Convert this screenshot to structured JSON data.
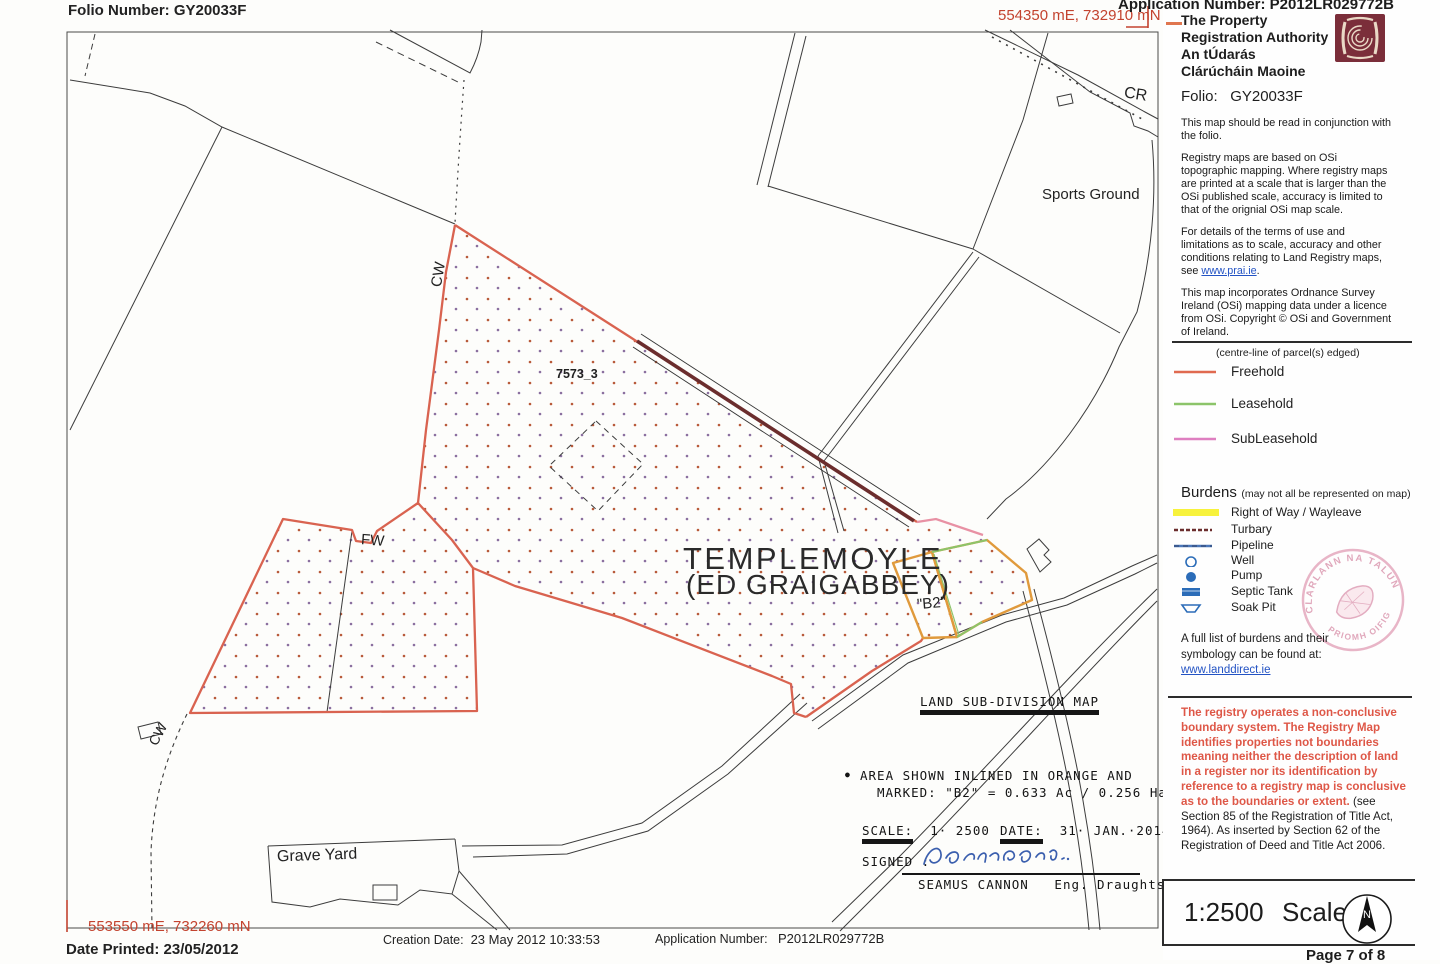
{
  "header": {
    "folio_number": "Folio Number: GY20033F",
    "application_number": "Application Number: P2012LR029772B",
    "coord_top": "554350 mE, 732910 mN"
  },
  "panel": {
    "authority_line1": "The Property",
    "authority_line2": "Registration Authority",
    "authority_line3": "An tÚdarás",
    "authority_line4": "Clárúcháin Maoine",
    "folio_label": "Folio:",
    "folio_value": "GY20033F",
    "para1": "This map should be read in conjunction with the folio.",
    "para2": "Registry maps are based on OSi topographic mapping. Where registry maps are printed at a scale that is larger than the OSi published scale, accuracy is limited to that of the orignial OSi map scale.",
    "para3_pre": "For details of the terms of use and limitations as to scale, accuracy and other conditions relating to Land Registry maps, see ",
    "para3_link": "www.prai.ie",
    "para3_post": ".",
    "para4": "This map incorporates Ordnance Survey Ireland (OSi) mapping data under a licence from OSi. Copyright © OSi and Government of Ireland.",
    "legend_note": "(centre-line of parcel(s) edged)",
    "legend": [
      {
        "label": "Freehold",
        "color": "#e06a50"
      },
      {
        "label": "Leasehold",
        "color": "#8cc46a"
      },
      {
        "label": "SubLeasehold",
        "color": "#de7fc0"
      }
    ],
    "burdens_title": "Burdens",
    "burdens_note": "(may not all be represented on map)",
    "burdens": [
      {
        "label": "Right of Way / Wayleave",
        "symbol": "yellow-band",
        "color": "#f7f23c"
      },
      {
        "label": "Turbary",
        "symbol": "dark-red-dashed-line",
        "color": "#6b2d2d"
      },
      {
        "label": "Pipeline",
        "symbol": "blue-line",
        "color": "#4a76b8"
      },
      {
        "label": "Well",
        "symbol": "circle-outline",
        "color": "#2b6cb8"
      },
      {
        "label": "Pump",
        "symbol": "filled-circle",
        "color": "#2b6cb8"
      },
      {
        "label": "Septic Tank",
        "symbol": "filled-rect",
        "color": "#2b6cb8"
      },
      {
        "label": "Soak Pit",
        "symbol": "trapezoid-outline",
        "color": "#2b6cb8"
      }
    ],
    "burdens_footer_line1": "A full list of burdens and their",
    "burdens_footer_line2": "symbology can be found at:",
    "burdens_footer_link": "www.landdirect.ie",
    "notice_red": "The registry operates a non-conclusive boundary system. The Registry Map identifies properties not boundaries meaning neither the description of land in a register nor its identification by reference to a registry map is conclusive as to the boundaries or extent.",
    "notice_black": " (see Section 85 of the Registration of Title Act, 1964). As inserted by Section 62 of the Registration of Deed and Title Act 2006.",
    "scale_value": "1:2500",
    "scale_word": "Scale",
    "page_label": "Page 7 of 8",
    "stamp_top": "CLARLANN NA TALUN",
    "stamp_bottom": "PRIOMH OIFIG",
    "compass_letter": "N"
  },
  "map": {
    "label_cr": "CR",
    "label_sports": "Sports Ground",
    "label_cw_top": "CW",
    "label_parcel": "7573_3",
    "townland_line1": "TEMPLEMOYLE",
    "townland_line2": "(ED GRAIGABBEY)",
    "label_b2": "\"B2\"",
    "label_fw": "FW",
    "label_cw_bottom": "CW",
    "label_graveyard": "Grave Yard",
    "subdivision": {
      "title": "LAND SUB-DIVISION MAP",
      "bullet": "●",
      "area_line1": "AREA  SHOWN INLINED IN ORANGE AND",
      "area_line2": "MARKED: \"B2\" = 0.633 Ac / 0.256 Ha.",
      "scale_label": "SCALE:",
      "scale_value": "1· 2500",
      "date_label": "DATE:",
      "date_value": "31· JAN.·2014",
      "signed_label": "SIGNED :",
      "signer_name": "SEAMUS CANNON",
      "signer_title": "Eng. Draughtsman"
    }
  },
  "footer": {
    "coord_bottom": "553550 mE, 732260 mN",
    "date_printed": "Date Printed: 23/05/2012",
    "creation_label": "Creation Date:",
    "creation_value": "23 May 2012 10:33:53",
    "application_label": "Application Number:",
    "application_value": "P2012LR029772B"
  }
}
